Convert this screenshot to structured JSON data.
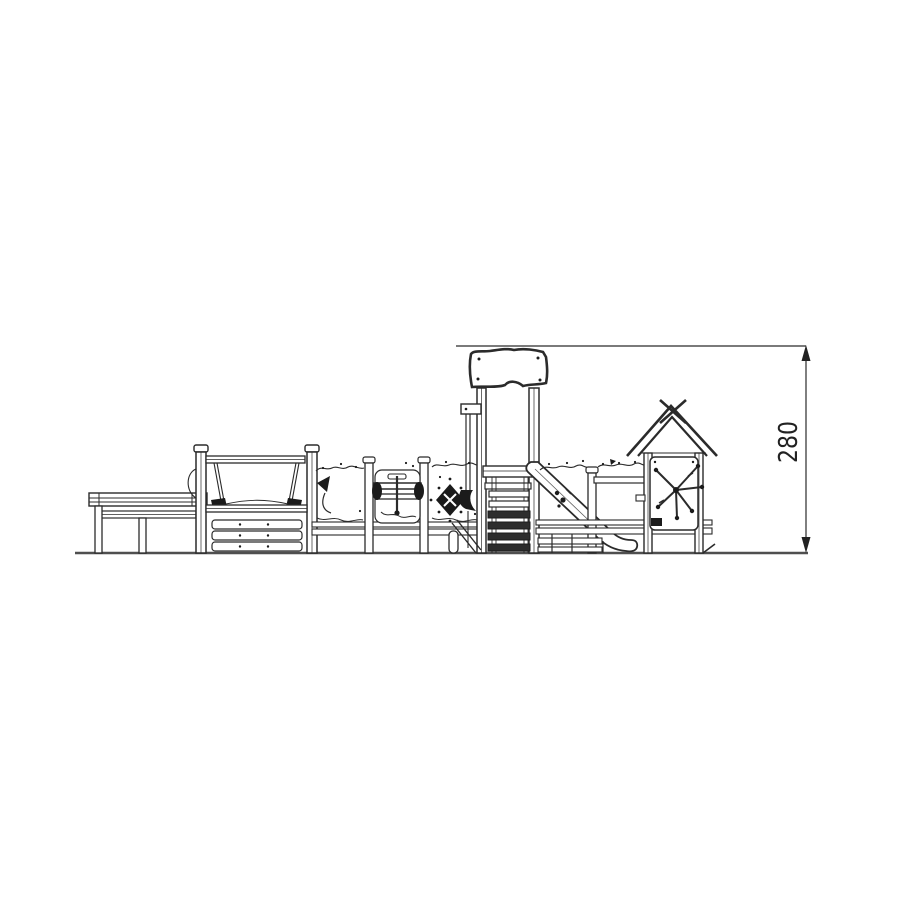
{
  "page": {
    "background_color": "#ffffff"
  },
  "drawing": {
    "title": "playground-structure-side-elevation",
    "style": "technical-line-drawing",
    "line_color": "#2b2b2b",
    "ground_color": "#4f4f4f",
    "dark_fill_color": "#1b1b1b",
    "dimension": {
      "value": "280",
      "orientation": "vertical",
      "arrow_style": "filled-triangles"
    },
    "components": [
      "ground-line",
      "picnic-table",
      "hammock-swing-frame",
      "slat-climbing-panel",
      "wavy-activity-panels",
      "pennant-flag-decal",
      "rotating-drum-play-panel",
      "diamond-climbing-hold",
      "main-tower-with-canopy-roof",
      "firemans-pole-with-elbow",
      "platform-and-ladder-steps",
      "slide",
      "guard-rails",
      "playhouse-with-gable-roof-and-cross-finial",
      "snowflake-panel-decal",
      "vertical-dimension-line"
    ]
  }
}
